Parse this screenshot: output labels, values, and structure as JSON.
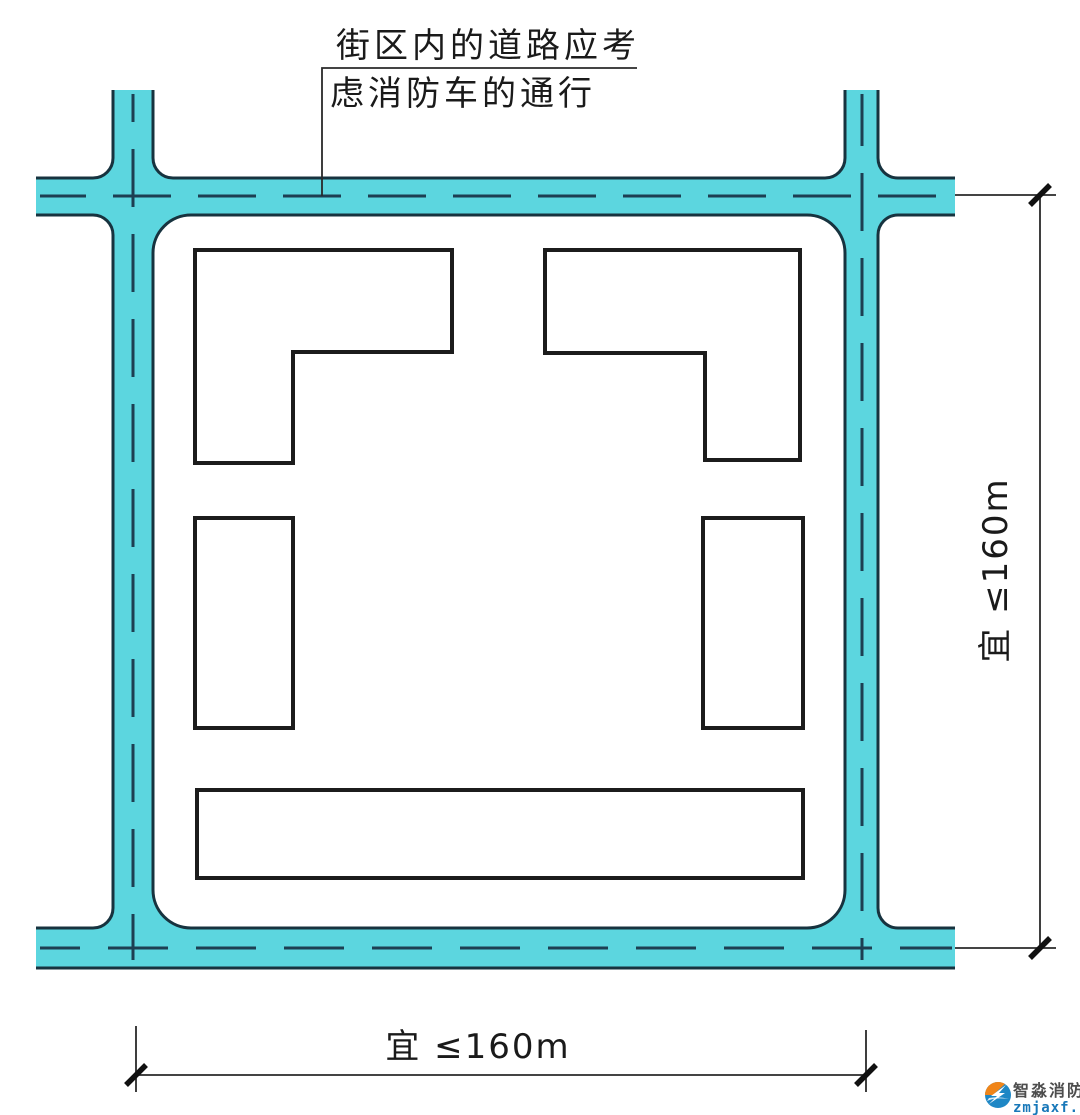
{
  "figure": {
    "callout": {
      "line1": "街区内的道路应考",
      "line2": "虑消防车的通行"
    },
    "dimensions": {
      "right_label": "宜 ≤160m",
      "bottom_label": "宜 ≤160m"
    },
    "watermark": {
      "name": "智淼消防",
      "domain": "zmjaxf.com"
    },
    "colors": {
      "road_fill": "#5CD6DF",
      "road_edge_line": "#17333F",
      "road_centerline": "#1D3F52",
      "building_outline": "#1C1C1C",
      "dimension_line": "#2A2A2A",
      "tick_mark": "#111111",
      "watermark_orange": "#F08519",
      "watermark_blue": "#1E87C5",
      "watermark_text_gray": "#4D4D4D"
    }
  }
}
